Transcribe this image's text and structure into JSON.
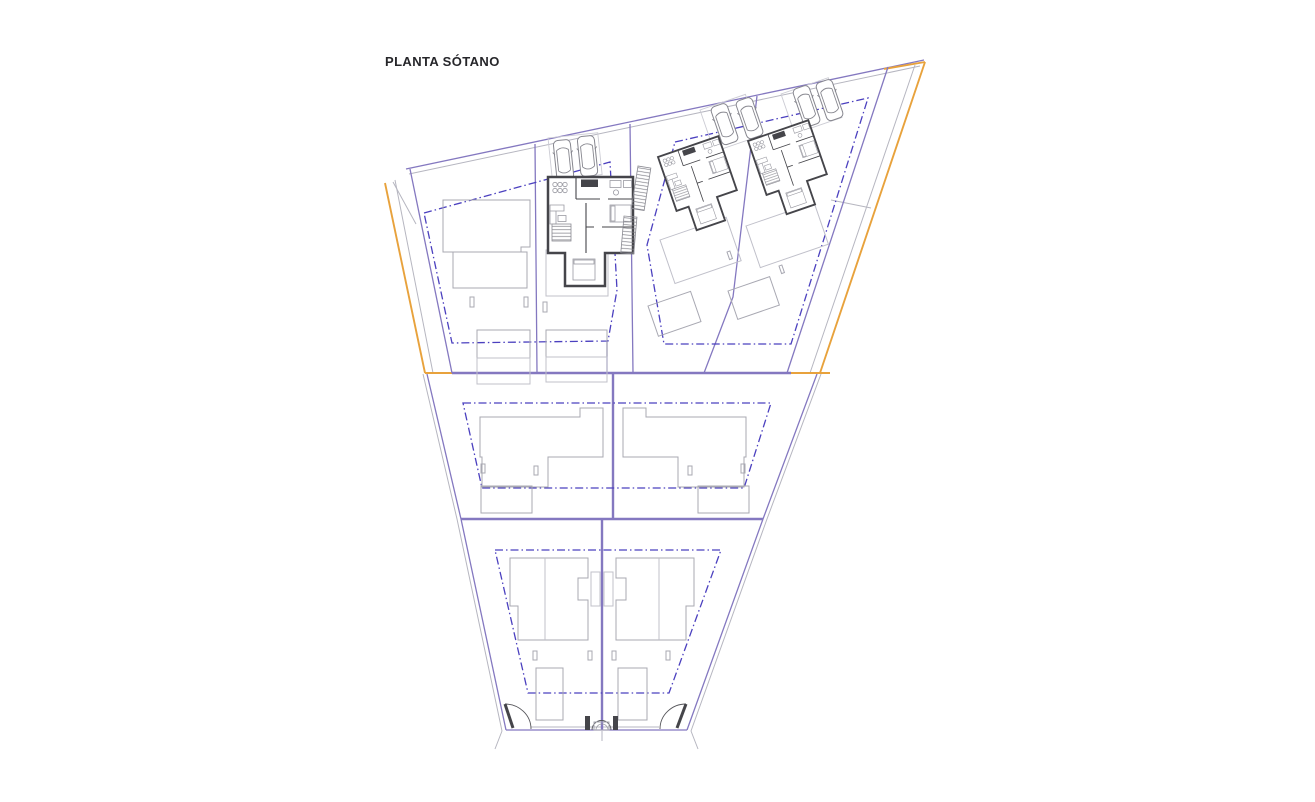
{
  "title": "PLANTA SÓTANO",
  "colors": {
    "background": "#ffffff",
    "plot_boundary_purple": "#8478c0",
    "setback_dash_blue": "#4b40bf",
    "site_edge_orange": "#e8a23c",
    "wall_dark_gray": "#45454a",
    "building_outline_gray": "#a8a8b2",
    "faint_outline_gray": "#c0c0ca",
    "survey_line_gray": "#b6b6c0"
  },
  "features": {
    "sections": [
      {
        "name": "upper-row",
        "plots": 4
      },
      {
        "name": "middle-row",
        "plots": 2
      },
      {
        "name": "lower-row",
        "plots": 2
      }
    ],
    "detailed_basement_units": 3,
    "outlined_units": 5,
    "parked_cars": 6,
    "pools_terraces": 6,
    "driveway_gates": 2,
    "pedestrian_gates": 1
  }
}
